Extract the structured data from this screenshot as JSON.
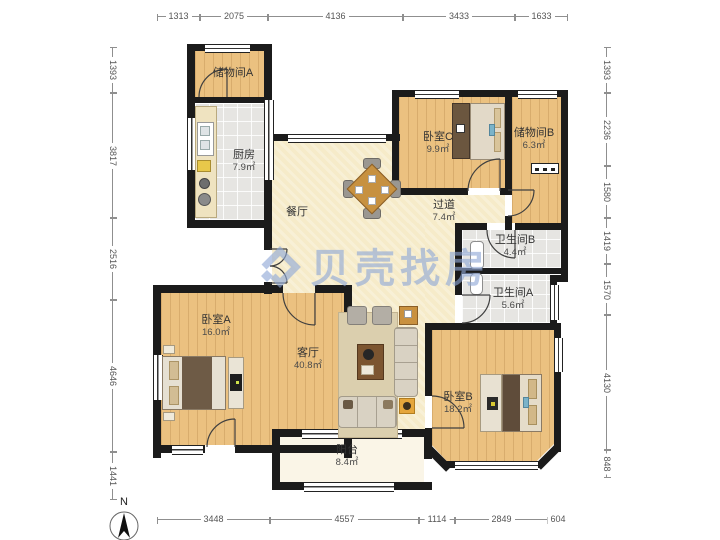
{
  "watermark": {
    "text": "贝壳找房",
    "color": "#8fa8d6"
  },
  "compass": {
    "label": "N"
  },
  "rooms": [
    {
      "id": "storage-a",
      "name": "储物间A",
      "area": ""
    },
    {
      "id": "kitchen",
      "name": "厨房",
      "area": "7.9㎡"
    },
    {
      "id": "dining",
      "name": "餐厅",
      "area": ""
    },
    {
      "id": "bedroom-c",
      "name": "卧室C",
      "area": "9.9㎡"
    },
    {
      "id": "storage-b",
      "name": "储物间B",
      "area": "6.3㎡"
    },
    {
      "id": "hallway",
      "name": "过道",
      "area": "7.4㎡"
    },
    {
      "id": "bathroom-b",
      "name": "卫生间B",
      "area": "4.4㎡"
    },
    {
      "id": "bathroom-a",
      "name": "卫生间A",
      "area": "5.6㎡"
    },
    {
      "id": "bedroom-a",
      "name": "卧室A",
      "area": "16.0㎡"
    },
    {
      "id": "living",
      "name": "客厅",
      "area": "40.8㎡"
    },
    {
      "id": "bedroom-b",
      "name": "卧室B",
      "area": "18.2㎡"
    },
    {
      "id": "balcony",
      "name": "阳台",
      "area": "8.4㎡"
    }
  ],
  "dimensions": {
    "top": [
      "1313",
      "2075",
      "4136",
      "3433",
      "1633"
    ],
    "bottom": [
      "3448",
      "4557",
      "1114",
      "2849",
      "604"
    ],
    "left": [
      "1393",
      "3817",
      "2516",
      "4646",
      "1441"
    ],
    "right": [
      "1393",
      "2236",
      "1580",
      "1419",
      "1570",
      "4130",
      "848"
    ]
  }
}
